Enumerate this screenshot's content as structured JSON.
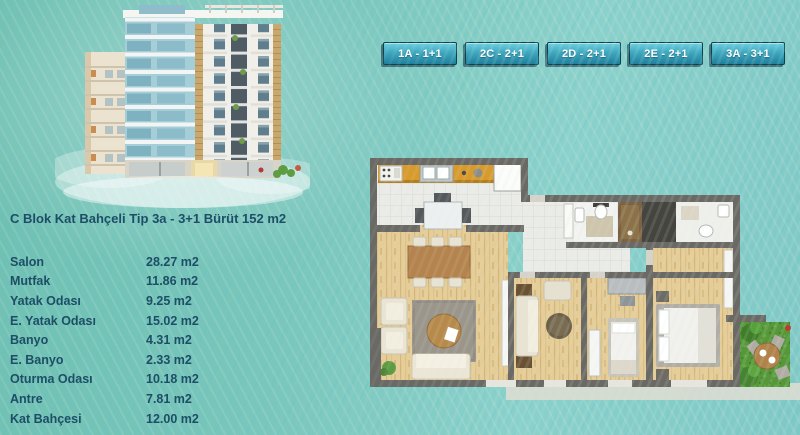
{
  "header": {
    "tabs": [
      {
        "label": "1A - 1+1"
      },
      {
        "label": "2C - 2+1"
      },
      {
        "label": "2D - 2+1"
      },
      {
        "label": "2E - 2+1"
      },
      {
        "label": "3A - 3+1"
      }
    ]
  },
  "unit": {
    "title": "C Blok Kat Bahçeli Tip 3a - 3+1 Bürüt 152 m2",
    "rooms": [
      {
        "name": "Salon",
        "area": "28.27 m2"
      },
      {
        "name": "Mutfak",
        "area": "11.86 m2"
      },
      {
        "name": "Yatak Odası",
        "area": "9.25 m2"
      },
      {
        "name": "E. Yatak Odası",
        "area": "15.02 m2"
      },
      {
        "name": "Banyo",
        "area": "4.31 m2"
      },
      {
        "name": "E. Banyo",
        "area": "2.33 m2"
      },
      {
        "name": "Oturma Odası",
        "area": "10.18 m2"
      },
      {
        "name": "Antre",
        "area": "7.81 m2"
      },
      {
        "name": "Kat Bahçesi",
        "area": "12.00 m2"
      }
    ]
  },
  "images": {
    "building": "apartment-building-3d-rendering",
    "floor_plan": "tip-3a-3plus1-floor-plan"
  },
  "colors": {
    "background": "#79c6bc",
    "tab_top": "#6ed0e0",
    "tab_bottom": "#1f809d",
    "tab_border": "#0e4251",
    "text": "#1d4e66"
  }
}
